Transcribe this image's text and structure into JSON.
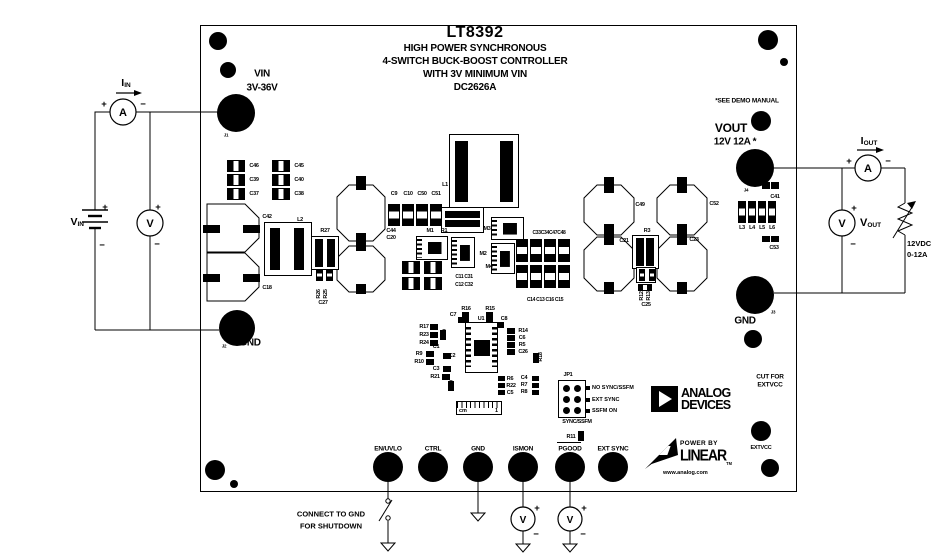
{
  "colors": {
    "ink": "#000000",
    "background": "#ffffff"
  },
  "title": {
    "part": "LT8392",
    "lines": [
      "HIGH POWER SYNCHRONOUS",
      "4-SWITCH BUCK-BOOST CONTROLLER",
      "WITH 3V MINIMUM VIN",
      "DC2626A"
    ]
  },
  "notes": {
    "see_demo": "*SEE DEMO MANUAL",
    "cut1": "CUT FOR",
    "cut2": "EXTVCC",
    "shutdown1": "CONNECT TO GND",
    "shutdown2": "FOR SHUTDOWN"
  },
  "io": {
    "vin_label": "VIN",
    "vin_range": "3V-36V",
    "gnd_in": "GND",
    "gnd_out": "GND",
    "vout_label": "VOUT",
    "vout_rating": "12V 12A *",
    "extvcc": "EXTVCC",
    "turrets": [
      {
        "label": "EN/UVLO",
        "x": 388
      },
      {
        "label": "CTRL",
        "x": 433
      },
      {
        "label": "GND",
        "x": 478
      },
      {
        "label": "ISMON",
        "x": 523
      },
      {
        "label": "PGOOD",
        "x": 570
      },
      {
        "label": "EXT SYNC",
        "x": 613
      }
    ]
  },
  "jp1": {
    "name": "JP1",
    "options": [
      "NO SYNC/SSFM",
      "EXT SYNC",
      "SSFM ON"
    ],
    "caption": "SYNC/SSFM"
  },
  "meters": {
    "ammeter": "A",
    "voltmeter": "V",
    "plus": "+",
    "minus": "−"
  },
  "external": {
    "iin_base": "I",
    "iin_sub": "IN",
    "vin_base": "V",
    "vin_sub": "IN",
    "iout_base": "I",
    "iout_sub": "OUT",
    "vout_base": "V",
    "vout_sub": "OUT",
    "load1": "12VDC",
    "load2": "0-12A"
  },
  "logos": {
    "adi1": "ANALOG",
    "adi2": "DEVICES",
    "power_by": "POWER BY",
    "linear": "LINEAR",
    "tm": "TM",
    "url": "www.analog.com"
  },
  "ruler": {
    "unit": "cm",
    "mark": "1"
  },
  "silkscreen": [
    {
      "t": "C46",
      "x": 254,
      "y": 166
    },
    {
      "t": "C39",
      "x": 254,
      "y": 180
    },
    {
      "t": "C37",
      "x": 254,
      "y": 194
    },
    {
      "t": "C45",
      "x": 299,
      "y": 166
    },
    {
      "t": "C40",
      "x": 299,
      "y": 180
    },
    {
      "t": "C38",
      "x": 299,
      "y": 194
    },
    {
      "t": "C42",
      "x": 267,
      "y": 217
    },
    {
      "t": "C18",
      "x": 267,
      "y": 288
    },
    {
      "t": "L2",
      "x": 300,
      "y": 220
    },
    {
      "t": "R27",
      "x": 325,
      "y": 231
    },
    {
      "t": "R26",
      "x": 319,
      "y": 294,
      "r": 1
    },
    {
      "t": "R25",
      "x": 326,
      "y": 294,
      "r": 1
    },
    {
      "t": "C27",
      "x": 323,
      "y": 303
    },
    {
      "t": "C44",
      "x": 391,
      "y": 231
    },
    {
      "t": "C20",
      "x": 391,
      "y": 238
    },
    {
      "t": "C9",
      "x": 394,
      "y": 194
    },
    {
      "t": "C10",
      "x": 408,
      "y": 194
    },
    {
      "t": "C50",
      "x": 422,
      "y": 194
    },
    {
      "t": "C51",
      "x": 436,
      "y": 194
    },
    {
      "t": "L1",
      "x": 445,
      "y": 185
    },
    {
      "t": "M1",
      "x": 430,
      "y": 231
    },
    {
      "t": "R1",
      "x": 444,
      "y": 231
    },
    {
      "t": "M3",
      "x": 487,
      "y": 229
    },
    {
      "t": "M2",
      "x": 483,
      "y": 254
    },
    {
      "t": "M4",
      "x": 489,
      "y": 267
    },
    {
      "t": "C33C34C47C48",
      "x": 549,
      "y": 233,
      "s": 5
    },
    {
      "t": "C11 C31",
      "x": 464,
      "y": 277,
      "s": 5
    },
    {
      "t": "C12 C32",
      "x": 464,
      "y": 285,
      "s": 5
    },
    {
      "t": "C14 C13 C16 C15",
      "x": 545,
      "y": 300,
      "s": 5
    },
    {
      "t": "R16",
      "x": 466,
      "y": 309
    },
    {
      "t": "R15",
      "x": 490,
      "y": 309
    },
    {
      "t": "C7",
      "x": 453,
      "y": 315
    },
    {
      "t": "C8",
      "x": 504,
      "y": 319
    },
    {
      "t": "U1",
      "x": 481,
      "y": 319
    },
    {
      "t": "R17",
      "x": 424,
      "y": 327
    },
    {
      "t": "R23",
      "x": 424,
      "y": 335
    },
    {
      "t": "R24",
      "x": 424,
      "y": 343
    },
    {
      "t": "R20",
      "x": 445,
      "y": 334,
      "r": 1
    },
    {
      "t": "C1",
      "x": 436,
      "y": 347
    },
    {
      "t": "R9",
      "x": 419,
      "y": 354
    },
    {
      "t": "R10",
      "x": 419,
      "y": 362
    },
    {
      "t": "C2",
      "x": 452,
      "y": 356
    },
    {
      "t": "C3",
      "x": 436,
      "y": 369
    },
    {
      "t": "R21",
      "x": 435,
      "y": 377
    },
    {
      "t": "R19",
      "x": 452,
      "y": 385,
      "r": 1
    },
    {
      "t": "R14",
      "x": 523,
      "y": 331
    },
    {
      "t": "C6",
      "x": 522,
      "y": 338
    },
    {
      "t": "R5",
      "x": 522,
      "y": 345
    },
    {
      "t": "C26",
      "x": 523,
      "y": 352
    },
    {
      "t": "R18",
      "x": 541,
      "y": 357,
      "r": 1
    },
    {
      "t": "R6",
      "x": 510,
      "y": 379
    },
    {
      "t": "R22",
      "x": 511,
      "y": 386
    },
    {
      "t": "C5",
      "x": 510,
      "y": 393
    },
    {
      "t": "C4",
      "x": 524,
      "y": 378
    },
    {
      "t": "R7",
      "x": 524,
      "y": 385
    },
    {
      "t": "R8",
      "x": 524,
      "y": 392
    },
    {
      "t": "C49",
      "x": 640,
      "y": 205
    },
    {
      "t": "C21",
      "x": 624,
      "y": 241
    },
    {
      "t": "C52",
      "x": 714,
      "y": 204
    },
    {
      "t": "C23",
      "x": 694,
      "y": 240
    },
    {
      "t": "R3",
      "x": 647,
      "y": 231
    },
    {
      "t": "R12",
      "x": 642,
      "y": 296,
      "r": 1
    },
    {
      "t": "R13",
      "x": 649,
      "y": 296,
      "r": 1
    },
    {
      "t": "C25",
      "x": 646,
      "y": 305
    },
    {
      "t": "C41",
      "x": 775,
      "y": 197
    },
    {
      "t": "L3",
      "x": 742,
      "y": 228
    },
    {
      "t": "L4",
      "x": 752,
      "y": 228
    },
    {
      "t": "L5",
      "x": 762,
      "y": 228
    },
    {
      "t": "L6",
      "x": 772,
      "y": 228
    },
    {
      "t": "C53",
      "x": 774,
      "y": 248
    },
    {
      "t": "J1",
      "x": 226,
      "y": 135,
      "s": 4.5
    },
    {
      "t": "J2",
      "x": 224,
      "y": 346,
      "s": 4.5
    },
    {
      "t": "J4",
      "x": 746,
      "y": 190,
      "s": 4.5
    },
    {
      "t": "J3",
      "x": 773,
      "y": 312,
      "s": 4.5
    },
    {
      "t": "R11",
      "x": 571,
      "y": 437
    }
  ]
}
